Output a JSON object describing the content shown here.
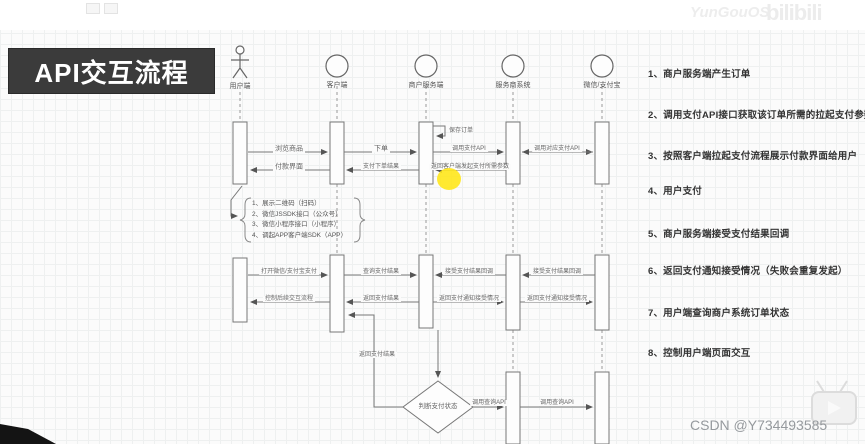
{
  "title": "API交互流程",
  "watermarks": {
    "top_text": "YunGouOS",
    "logo_text": "bilibili",
    "csdn": "CSDN @Y734493585"
  },
  "colors": {
    "title_bg": "#3b3b3b",
    "line_gray": "#777777",
    "highlight_yellow": "#ffe614"
  },
  "actors": [
    {
      "label": "用户端",
      "type": "person"
    },
    {
      "label": "客户端",
      "type": "circle"
    },
    {
      "label": "商户服务端",
      "type": "circle"
    },
    {
      "label": "服务商系统",
      "type": "circle"
    },
    {
      "label": "微信/支付宝",
      "type": "circle"
    }
  ],
  "messages": {
    "browse": "浏览商品",
    "pay_ui": "付款界面",
    "place_order": "下单",
    "order_result": "支付下单结果",
    "save_order": "保存订单",
    "call_pay_api": "调用支付API",
    "return_params": "返回客户端发起支付所需参数",
    "call_channel_api": "调用对应支付API",
    "open_wechat_alipay": "打开微信/支付宝支付",
    "control_flow": "控制后续交互流程",
    "query_result": "查询支付结果",
    "return_result": "返回支付结果",
    "recv_callback": "接受支付结果回调",
    "return_notify": "返回支付通知接受情况",
    "judge_status": "判断支付状态",
    "call_query_api": "调用查询API"
  },
  "note": {
    "lines": [
      "1、展示二维码（扫码）",
      "2、微信JSSDK接口（公众号）",
      "3、微信小程序接口（小程序）",
      "4、调起APP客户端SDK（APP）"
    ]
  },
  "steps": [
    "1、商户服务端产生订单",
    "2、调用支付API接口获取该订单所需的拉起支付参数",
    "3、按照客户端拉起支付流程展示付款界面给用户",
    "4、用户支付",
    "5、商户服务端接受支付结果回调",
    "6、返回支付通知接受情况（失败会重复发起）",
    "7、用户端查询商户系统订单状态",
    "8、控制用户端页面交互"
  ]
}
